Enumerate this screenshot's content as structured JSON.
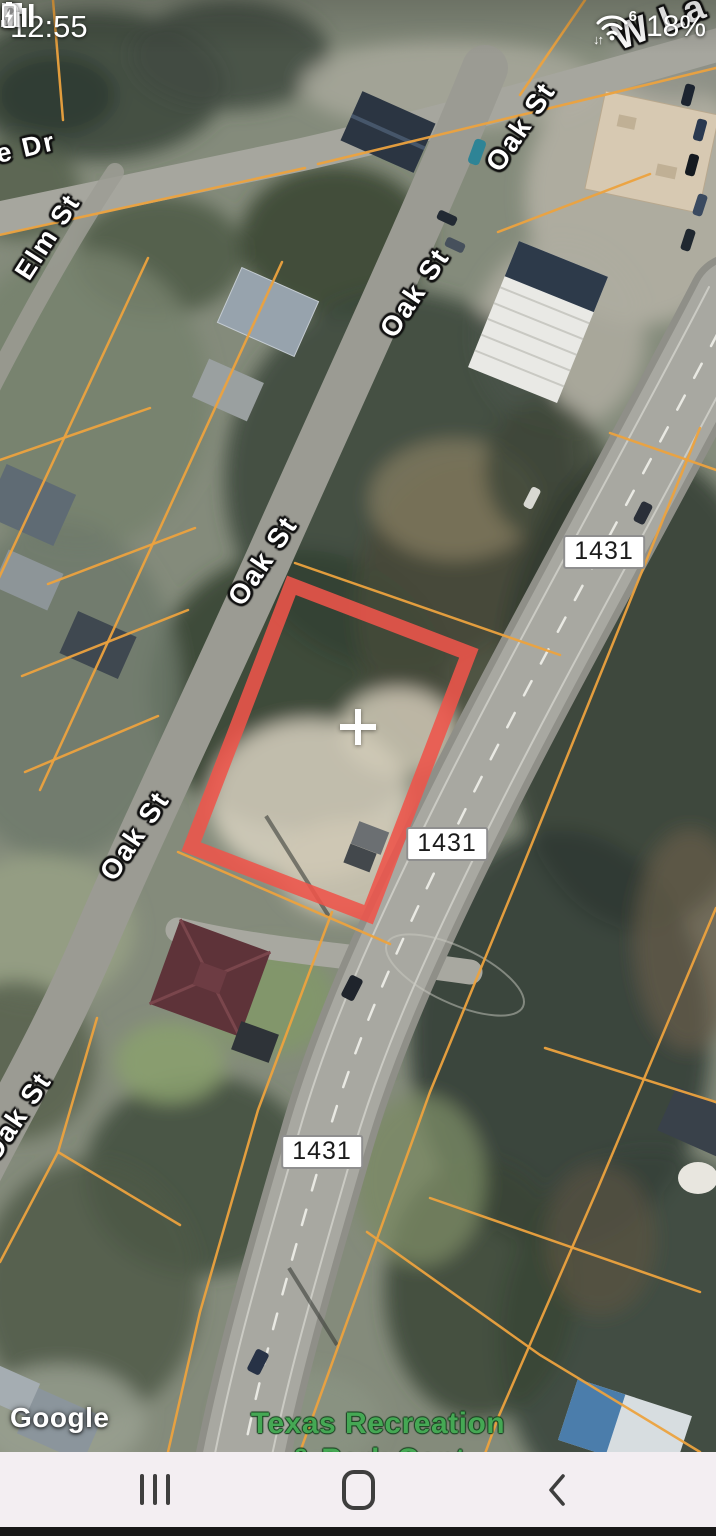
{
  "status_bar": {
    "time": "12:55",
    "battery_percent": "18%",
    "wifi_standard": "6",
    "wifi_activity_arrows": "↓↑",
    "icons": [
      "lock-icon",
      "flipboard-notification-icon",
      "bluetooth-icon",
      "location-icon",
      "wifi6-icon",
      "signal-strength-icon",
      "battery-charging-icon"
    ]
  },
  "map": {
    "street_labels": {
      "drive_partial": "e Dr",
      "elm_street": "Elm St",
      "oak_street": "Oak St",
      "top_right_partial": "W La"
    },
    "route_shield": "1431",
    "poi_label": {
      "line1": "Texas Recreation",
      "line2": "& Park Cent"
    },
    "watermark": "Google",
    "colors": {
      "selected_parcel_outline": "#ee544a",
      "parcel_lines": "#eca23e",
      "poi_text": "#45a854"
    }
  },
  "nav_bar": {
    "buttons": [
      "recents",
      "home",
      "back"
    ]
  }
}
